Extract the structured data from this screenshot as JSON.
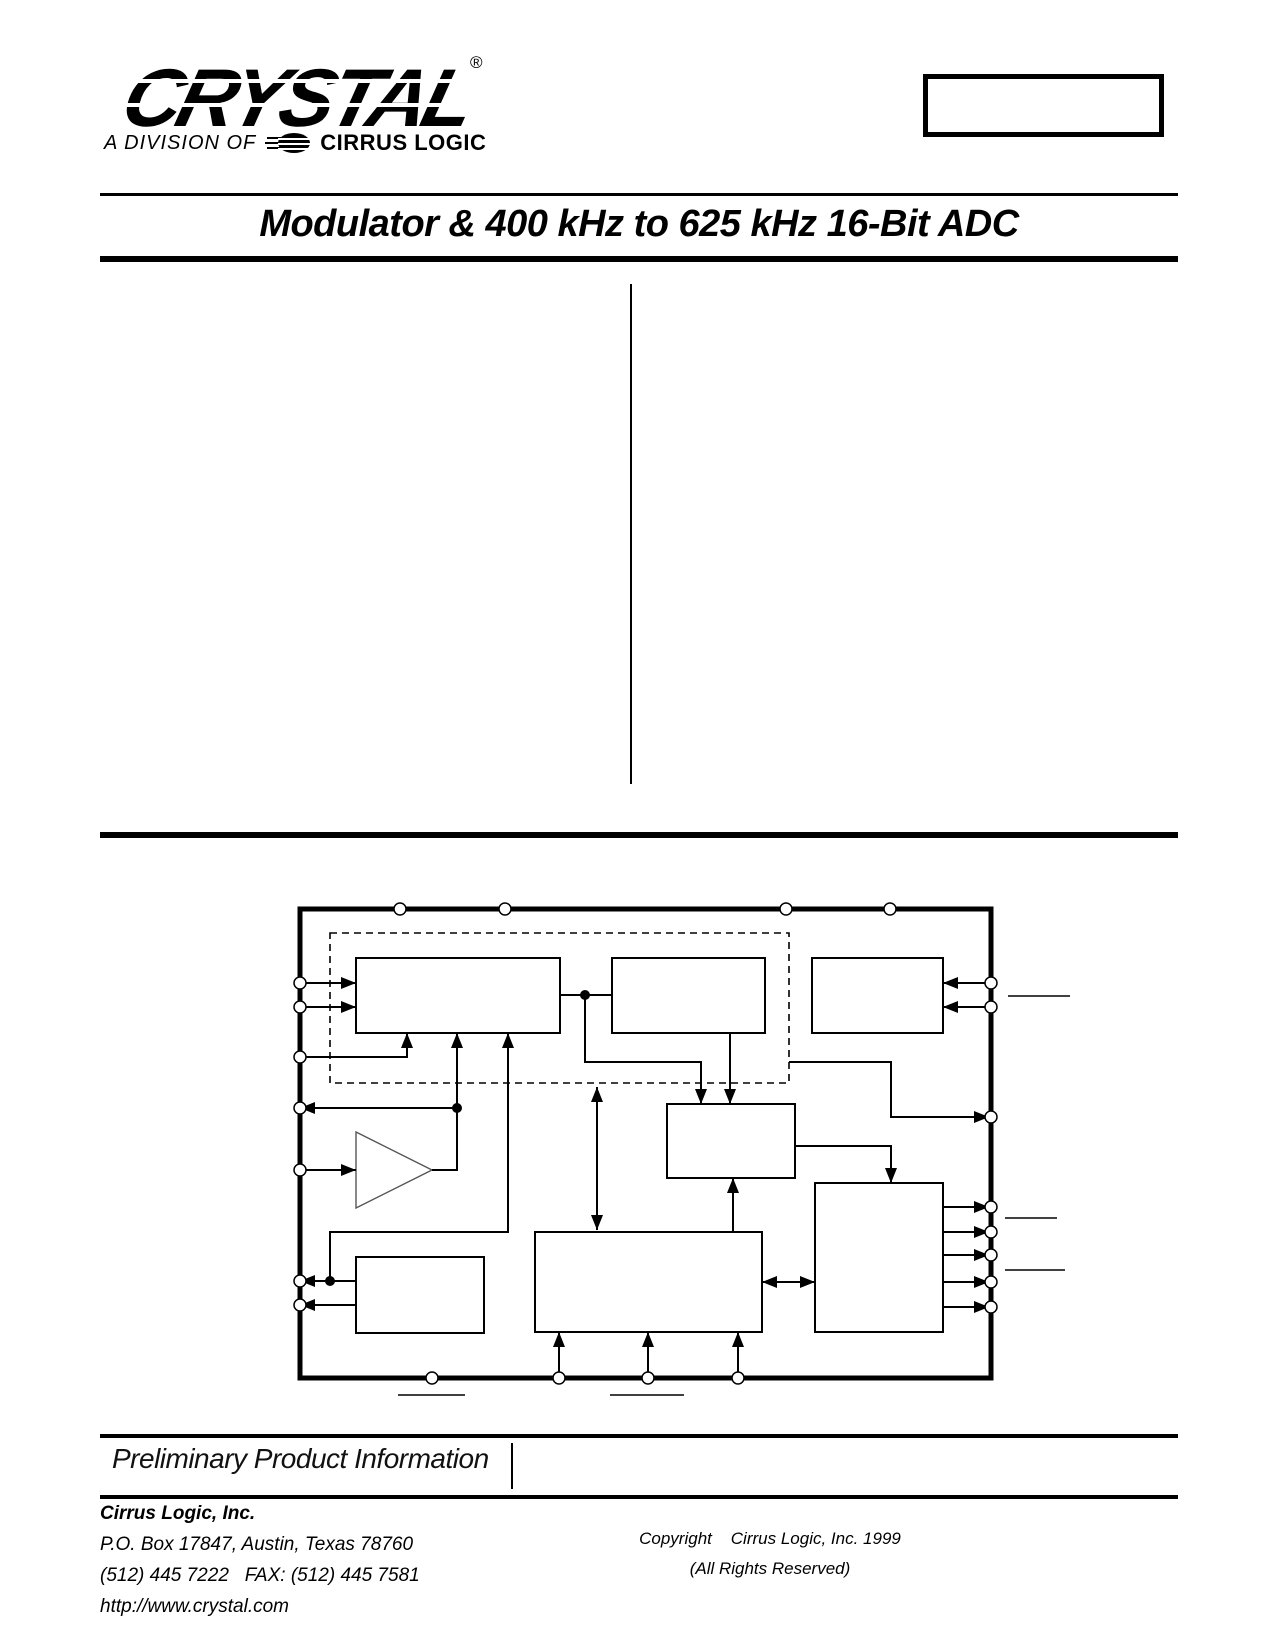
{
  "page": {
    "background": "#ffffff",
    "ink": "#000000"
  },
  "logo": {
    "brand": "CRYSTAL",
    "registered_mark": "®",
    "division_prefix": "A DIVISION OF",
    "division_brand": "CIRRUS LOGIC"
  },
  "header": {
    "title": "Modulator & 400 kHz to 625 kHz 16-Bit ADC"
  },
  "banner": {
    "text": "Preliminary Product Information"
  },
  "footer": {
    "company": "Cirrus Logic, Inc.",
    "address": "P.O. Box 17847, Austin, Texas 78760",
    "phone_fax": "(512) 445 7222   FAX: (512) 445 7581",
    "website": "http://www.crystal.com",
    "copyright_line1": "Copyright    Cirrus Logic, Inc. 1999",
    "copyright_line2": "(All Rights Reserved)"
  }
}
